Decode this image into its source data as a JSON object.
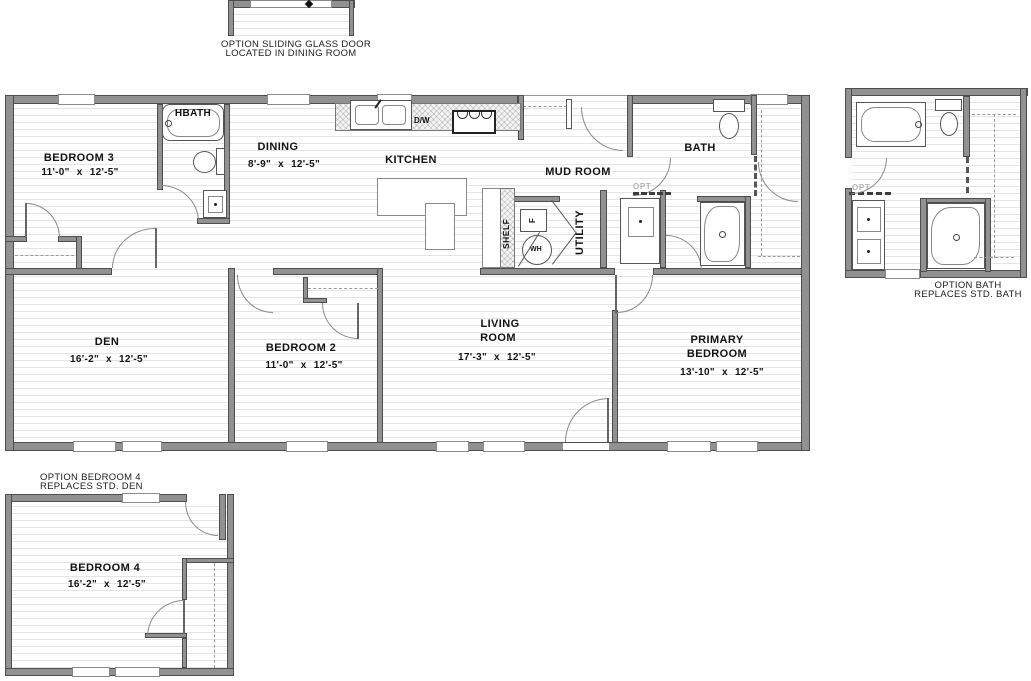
{
  "rooms": {
    "bedroom3": {
      "name": "BEDROOM 3",
      "dims": "11'-0\" x 12'-5\""
    },
    "hbath": {
      "name": "HBATH"
    },
    "dining": {
      "name": "DINING",
      "dims": "8'-9\" x 12'-5\""
    },
    "kitchen": {
      "name": "KITCHEN"
    },
    "mudroom": {
      "name": "MUD ROOM"
    },
    "bath": {
      "name": "BATH"
    },
    "utility": {
      "name": "UTILITY"
    },
    "den": {
      "name": "DEN",
      "dims": "16'-2\" x 12'-5\""
    },
    "bedroom2": {
      "name": "BEDROOM 2",
      "dims": "11'-0\" x 12'-5\""
    },
    "living": {
      "name_line1": "LIVING",
      "name_line2": "ROOM",
      "dims": "17'-3\" x 12'-5\""
    },
    "primary": {
      "name_line1": "PRIMARY",
      "name_line2": "BEDROOM",
      "dims": "13'-10\" x 12'-5\""
    }
  },
  "fixtures": {
    "shelf": "SHELF",
    "dishwasher": "D/W",
    "water_heater": "WH",
    "furnace": "F"
  },
  "options": {
    "opt_label": "OPT",
    "sliding_door": {
      "line1": "OPTION SLIDING GLASS DOOR",
      "line2": "LOCATED IN DINING ROOM"
    },
    "bath": {
      "line1": "OPTION BATH",
      "line2": "REPLACES STD. BATH"
    },
    "bedroom4": {
      "line1": "OPTION BEDROOM 4",
      "line2": "REPLACES STD. DEN",
      "room": {
        "name": "BEDROOM 4",
        "dims": "16'-2\" x 12'-5\""
      }
    }
  },
  "colors": {
    "wall": "#919191",
    "wall_outline": "#4e4e4e",
    "floor_line": "#e4e4e4",
    "text": "#121212",
    "opt_text": "#b5b5b5"
  }
}
